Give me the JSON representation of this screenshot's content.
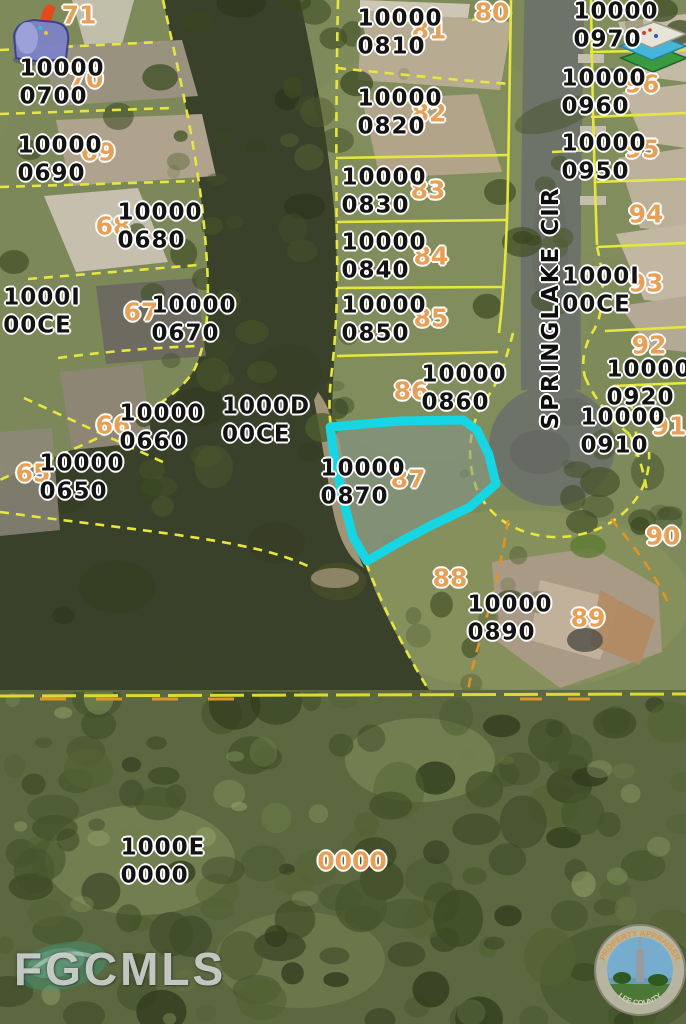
{
  "map": {
    "street_label": "SPRINGLAKE CIR",
    "watermark": "FGCMLS",
    "seal": {
      "top_text": "PROPERTY APPRAISER",
      "bottom_text": "LEE COUNTY"
    },
    "highlighted_parcel": {
      "id": "10000 0870",
      "lot": "87"
    },
    "colors": {
      "parcel_line": "#e6e73e",
      "easement_line": "#de9428",
      "highlight_outline": "#16d6e4",
      "lot_number": "#e7a057",
      "parcel_text": "#131313",
      "water": "#39412a",
      "road": "#6e736a"
    },
    "parcel_labels": [
      {
        "line1": "10000",
        "line2": "0700",
        "x": 62,
        "y": 83
      },
      {
        "line1": "10000",
        "line2": "0690",
        "x": 60,
        "y": 160
      },
      {
        "line1": "10000",
        "line2": "0680",
        "x": 160,
        "y": 227
      },
      {
        "line1": "1000I",
        "line2": "00CE",
        "x": 42,
        "y": 312
      },
      {
        "line1": "10000",
        "line2": "0670",
        "x": 194,
        "y": 320
      },
      {
        "line1": "10000",
        "line2": "0660",
        "x": 162,
        "y": 428
      },
      {
        "line1": "10000",
        "line2": "0650",
        "x": 82,
        "y": 478
      },
      {
        "line1": "1000D",
        "line2": "00CE",
        "x": 266,
        "y": 421
      },
      {
        "line1": "10000",
        "line2": "0810",
        "x": 400,
        "y": 33
      },
      {
        "line1": "10000",
        "line2": "0820",
        "x": 400,
        "y": 113
      },
      {
        "line1": "10000",
        "line2": "0830",
        "x": 384,
        "y": 192
      },
      {
        "line1": "10000",
        "line2": "0840",
        "x": 384,
        "y": 257
      },
      {
        "line1": "10000",
        "line2": "0850",
        "x": 384,
        "y": 320
      },
      {
        "line1": "10000",
        "line2": "0860",
        "x": 464,
        "y": 389
      },
      {
        "line1": "10000",
        "line2": "0870",
        "x": 363,
        "y": 483
      },
      {
        "line1": "10000",
        "line2": "0890",
        "x": 510,
        "y": 619
      },
      {
        "line1": "10000",
        "line2": "0970",
        "x": 616,
        "y": 26
      },
      {
        "line1": "10000",
        "line2": "0960",
        "x": 604,
        "y": 93
      },
      {
        "line1": "10000",
        "line2": "0950",
        "x": 604,
        "y": 158
      },
      {
        "line1": "1000I",
        "line2": "00CE",
        "x": 601,
        "y": 291
      },
      {
        "line1": "10000",
        "line2": "0920",
        "x": 649,
        "y": 384
      },
      {
        "line1": "10000",
        "line2": "0910",
        "x": 623,
        "y": 432
      },
      {
        "line1": "1000E",
        "line2": "0000",
        "x": 163,
        "y": 862
      }
    ],
    "lot_labels": [
      {
        "text": "71",
        "x": 79,
        "y": 15
      },
      {
        "text": "70",
        "x": 86,
        "y": 79
      },
      {
        "text": "69",
        "x": 98,
        "y": 152
      },
      {
        "text": "68",
        "x": 113,
        "y": 226
      },
      {
        "text": "67",
        "x": 141,
        "y": 312
      },
      {
        "text": "66",
        "x": 113,
        "y": 425
      },
      {
        "text": "65",
        "x": 33,
        "y": 473
      },
      {
        "text": "80",
        "x": 492,
        "y": 12
      },
      {
        "text": "81",
        "x": 429,
        "y": 30
      },
      {
        "text": "82",
        "x": 429,
        "y": 113
      },
      {
        "text": "83",
        "x": 428,
        "y": 190
      },
      {
        "text": "84",
        "x": 431,
        "y": 256
      },
      {
        "text": "85",
        "x": 431,
        "y": 318
      },
      {
        "text": "86",
        "x": 411,
        "y": 391
      },
      {
        "text": "87",
        "x": 408,
        "y": 479
      },
      {
        "text": "88",
        "x": 450,
        "y": 578
      },
      {
        "text": "89",
        "x": 588,
        "y": 618
      },
      {
        "text": "90",
        "x": 663,
        "y": 536
      },
      {
        "text": "91",
        "x": 669,
        "y": 426
      },
      {
        "text": "92",
        "x": 649,
        "y": 345
      },
      {
        "text": "93",
        "x": 646,
        "y": 283
      },
      {
        "text": "94",
        "x": 646,
        "y": 214
      },
      {
        "text": "95",
        "x": 642,
        "y": 149
      },
      {
        "text": "96",
        "x": 642,
        "y": 84
      },
      {
        "text": "0000",
        "x": 352,
        "y": 861
      }
    ],
    "icons": {
      "top_left": "mailbox-logo",
      "top_right": "map-layers",
      "bottom_left": "fgcmls-watermark",
      "bottom_right": "lee-county-property-appraiser-seal"
    }
  }
}
